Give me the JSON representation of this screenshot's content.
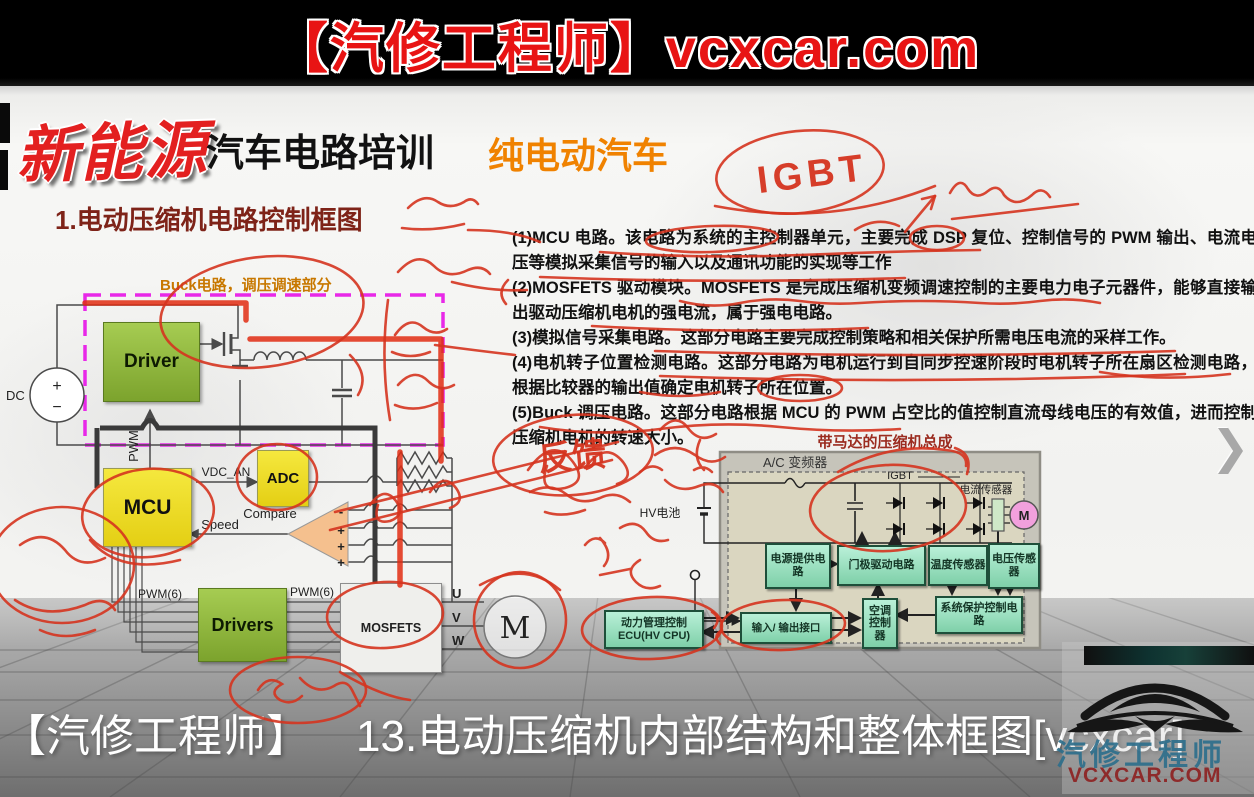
{
  "banner": {
    "text": "【汽修工程师】vcxcar.com"
  },
  "header": {
    "brand": "新能源",
    "course": "汽车电路培训",
    "tag": "纯电动汽车"
  },
  "slide": {
    "heading": "1.电动压缩机电路控制框图",
    "points": [
      "(1)MCU 电路。该电路为系统的主控制器单元，主要完成 DSP 复位、控制信号的 PWM 输出、电流电压等模拟采集信号的输入以及通讯功能的实现等工作",
      "(2)MOSFETS 驱动模块。MOSFETS 是完成压缩机变频调速控制的主要电力电子元器件，能够直接输出驱动压缩机电机的强电流，属于强电电路。",
      "(3)模拟信号采集电路。这部分电路主要完成控制策略和相关保护所需电压电流的采样工作。",
      "(4)电机转子位置检测电路。这部分电路为电机运行到自同步控速阶段时电机转子所在扇区检测电路，根据比较器的输出值确定电机转子所在位置。",
      "(5)Buck 调压电路。这部分电路根据 MCU 的 PWM 占空比的值控制直流母线电压的有效值，进而控制压缩机电机的转速大小。"
    ]
  },
  "block_diagram": {
    "buck_label": "Buck电路，调压调速部分",
    "dc_label": "DC",
    "plus": "+",
    "minus": "−",
    "driver": "Driver",
    "pwm": "PWM",
    "mcu": "MCU",
    "adc": "ADC",
    "vdc_an": "VDC_AN",
    "speed": "Speed",
    "compare": "Compare",
    "cmp_minus": "-",
    "cmp_plus": "+",
    "pwm6_left": "PWM(6)",
    "pwm6_right": "PWM(6)",
    "drivers": "Drivers",
    "mosfets": "MOSFETS",
    "phase_u": "U",
    "phase_v": "V",
    "phase_w": "W",
    "motor": "M"
  },
  "compressor_diagram": {
    "title": "带马达的压缩机总成",
    "inverter_label": "A/C 变频器",
    "hv_battery": "HV电池",
    "igbt": "IGBT",
    "current_sensor": "电流传感器",
    "motor": "M",
    "power_supply": "电源提供电路",
    "gate_drive": "门极驱动电路",
    "temp_sensor": "温度传感器",
    "voltage_sensor": "电压传感器",
    "io_interface": "输入/ 输出接口",
    "ac_controller": "空调控制器",
    "system_protection": "系统保护控制电路",
    "pm_ecu_line1": "动力管理控制",
    "pm_ecu_line2": "ECU(HV CPU)"
  },
  "handwriting": {
    "igbt": "IGBT",
    "feedback": "反馈"
  },
  "caption": {
    "channel": "【汽修工程师】",
    "title": "13.电动压缩机内部结构和整体框图[vcxcar]"
  },
  "logo": {
    "name": "汽修工程师",
    "site": "VCXCAR.COM"
  },
  "player": {
    "next_icon": "❯"
  },
  "colors": {
    "banner_text": "#e81414",
    "brand_red": "#e32020",
    "tag_orange": "#f08200",
    "heading_red": "#7e2318",
    "annotation_red": "#d5341f",
    "magenta_dashed": "#e828e8"
  }
}
